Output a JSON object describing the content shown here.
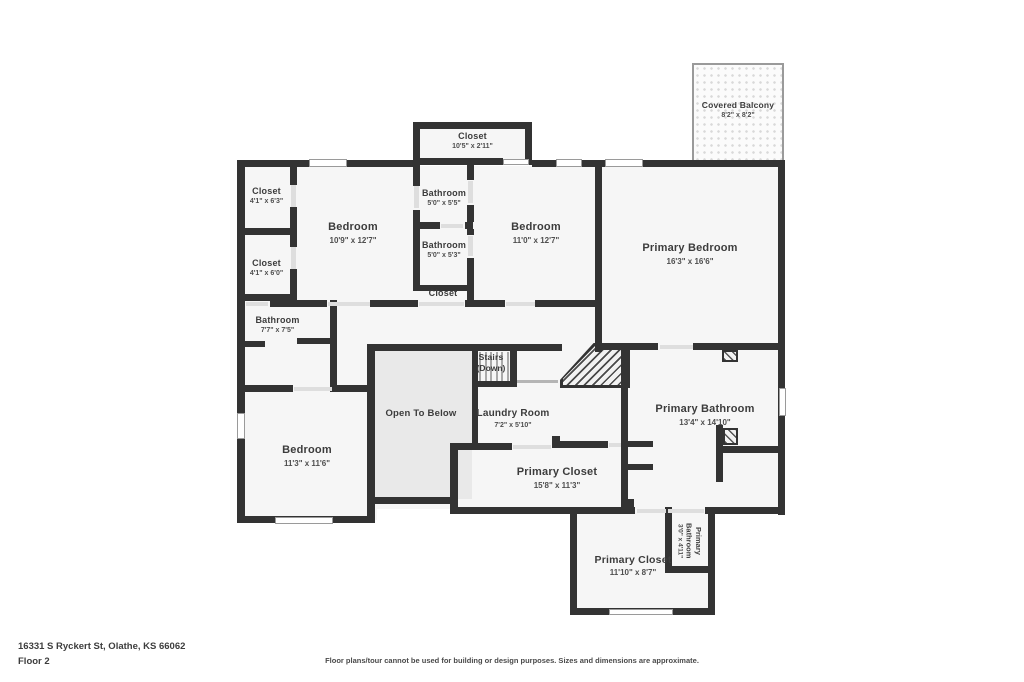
{
  "colors": {
    "wall": "#333333",
    "room_fill": "#f6f6f6",
    "open_below_fill": "#e9e9e9",
    "label_text": "#3c3c3c"
  },
  "rooms": [
    {
      "id": "covered-balcony",
      "name": "Covered Balcony",
      "dims": "8'2\" x 8'2\""
    },
    {
      "id": "closet-top",
      "name": "Closet",
      "dims": "10'5\" x 2'11\""
    },
    {
      "id": "closet-upper-left",
      "name": "Closet",
      "dims": "4'1\" x 6'3\""
    },
    {
      "id": "closet-mid-left",
      "name": "Closet",
      "dims": "4'1\" x 6'0\""
    },
    {
      "id": "bedroom-1",
      "name": "Bedroom",
      "dims": "10'9\" x 12'7\""
    },
    {
      "id": "bathroom-top",
      "name": "Bathroom",
      "dims": "5'0\" x 5'5\""
    },
    {
      "id": "bathroom-mid",
      "name": "Bathroom",
      "dims": "5'0\" x 5'3\""
    },
    {
      "id": "closet-small",
      "name": "Closet",
      "dims": ""
    },
    {
      "id": "bedroom-2",
      "name": "Bedroom",
      "dims": "11'0\" x 12'7\""
    },
    {
      "id": "primary-bedroom",
      "name": "Primary Bedroom",
      "dims": "16'3\" x 16'6\""
    },
    {
      "id": "bathroom-left",
      "name": "Bathroom",
      "dims": "7'7\" x 7'5\""
    },
    {
      "id": "stairs",
      "name": "Stairs",
      "dims": "(Down)"
    },
    {
      "id": "open-to-below",
      "name": "Open To Below",
      "dims": ""
    },
    {
      "id": "laundry-room",
      "name": "Laundry Room",
      "dims": "7'2\" x 5'10\""
    },
    {
      "id": "primary-bathroom",
      "name": "Primary Bathroom",
      "dims": "13'4\" x 14'10\""
    },
    {
      "id": "bedroom-3",
      "name": "Bedroom",
      "dims": "11'3\" x 11'6\""
    },
    {
      "id": "primary-closet-upper",
      "name": "Primary Closet",
      "dims": "15'8\" x 11'3\""
    },
    {
      "id": "primary-closet-lower",
      "name": "Primary Closet",
      "dims": "11'10\" x 8'7\""
    },
    {
      "id": "primary-bathroom-small",
      "name": "Primary Bathroom",
      "dims": "3'0\" x 4'11\""
    }
  ],
  "footer": {
    "address": "16331 S Ryckert St, Olathe, KS 66062",
    "floor": "Floor 2",
    "disclaimer": "Floor plans/tour cannot be used for building or design purposes. Sizes and dimensions are approximate."
  }
}
